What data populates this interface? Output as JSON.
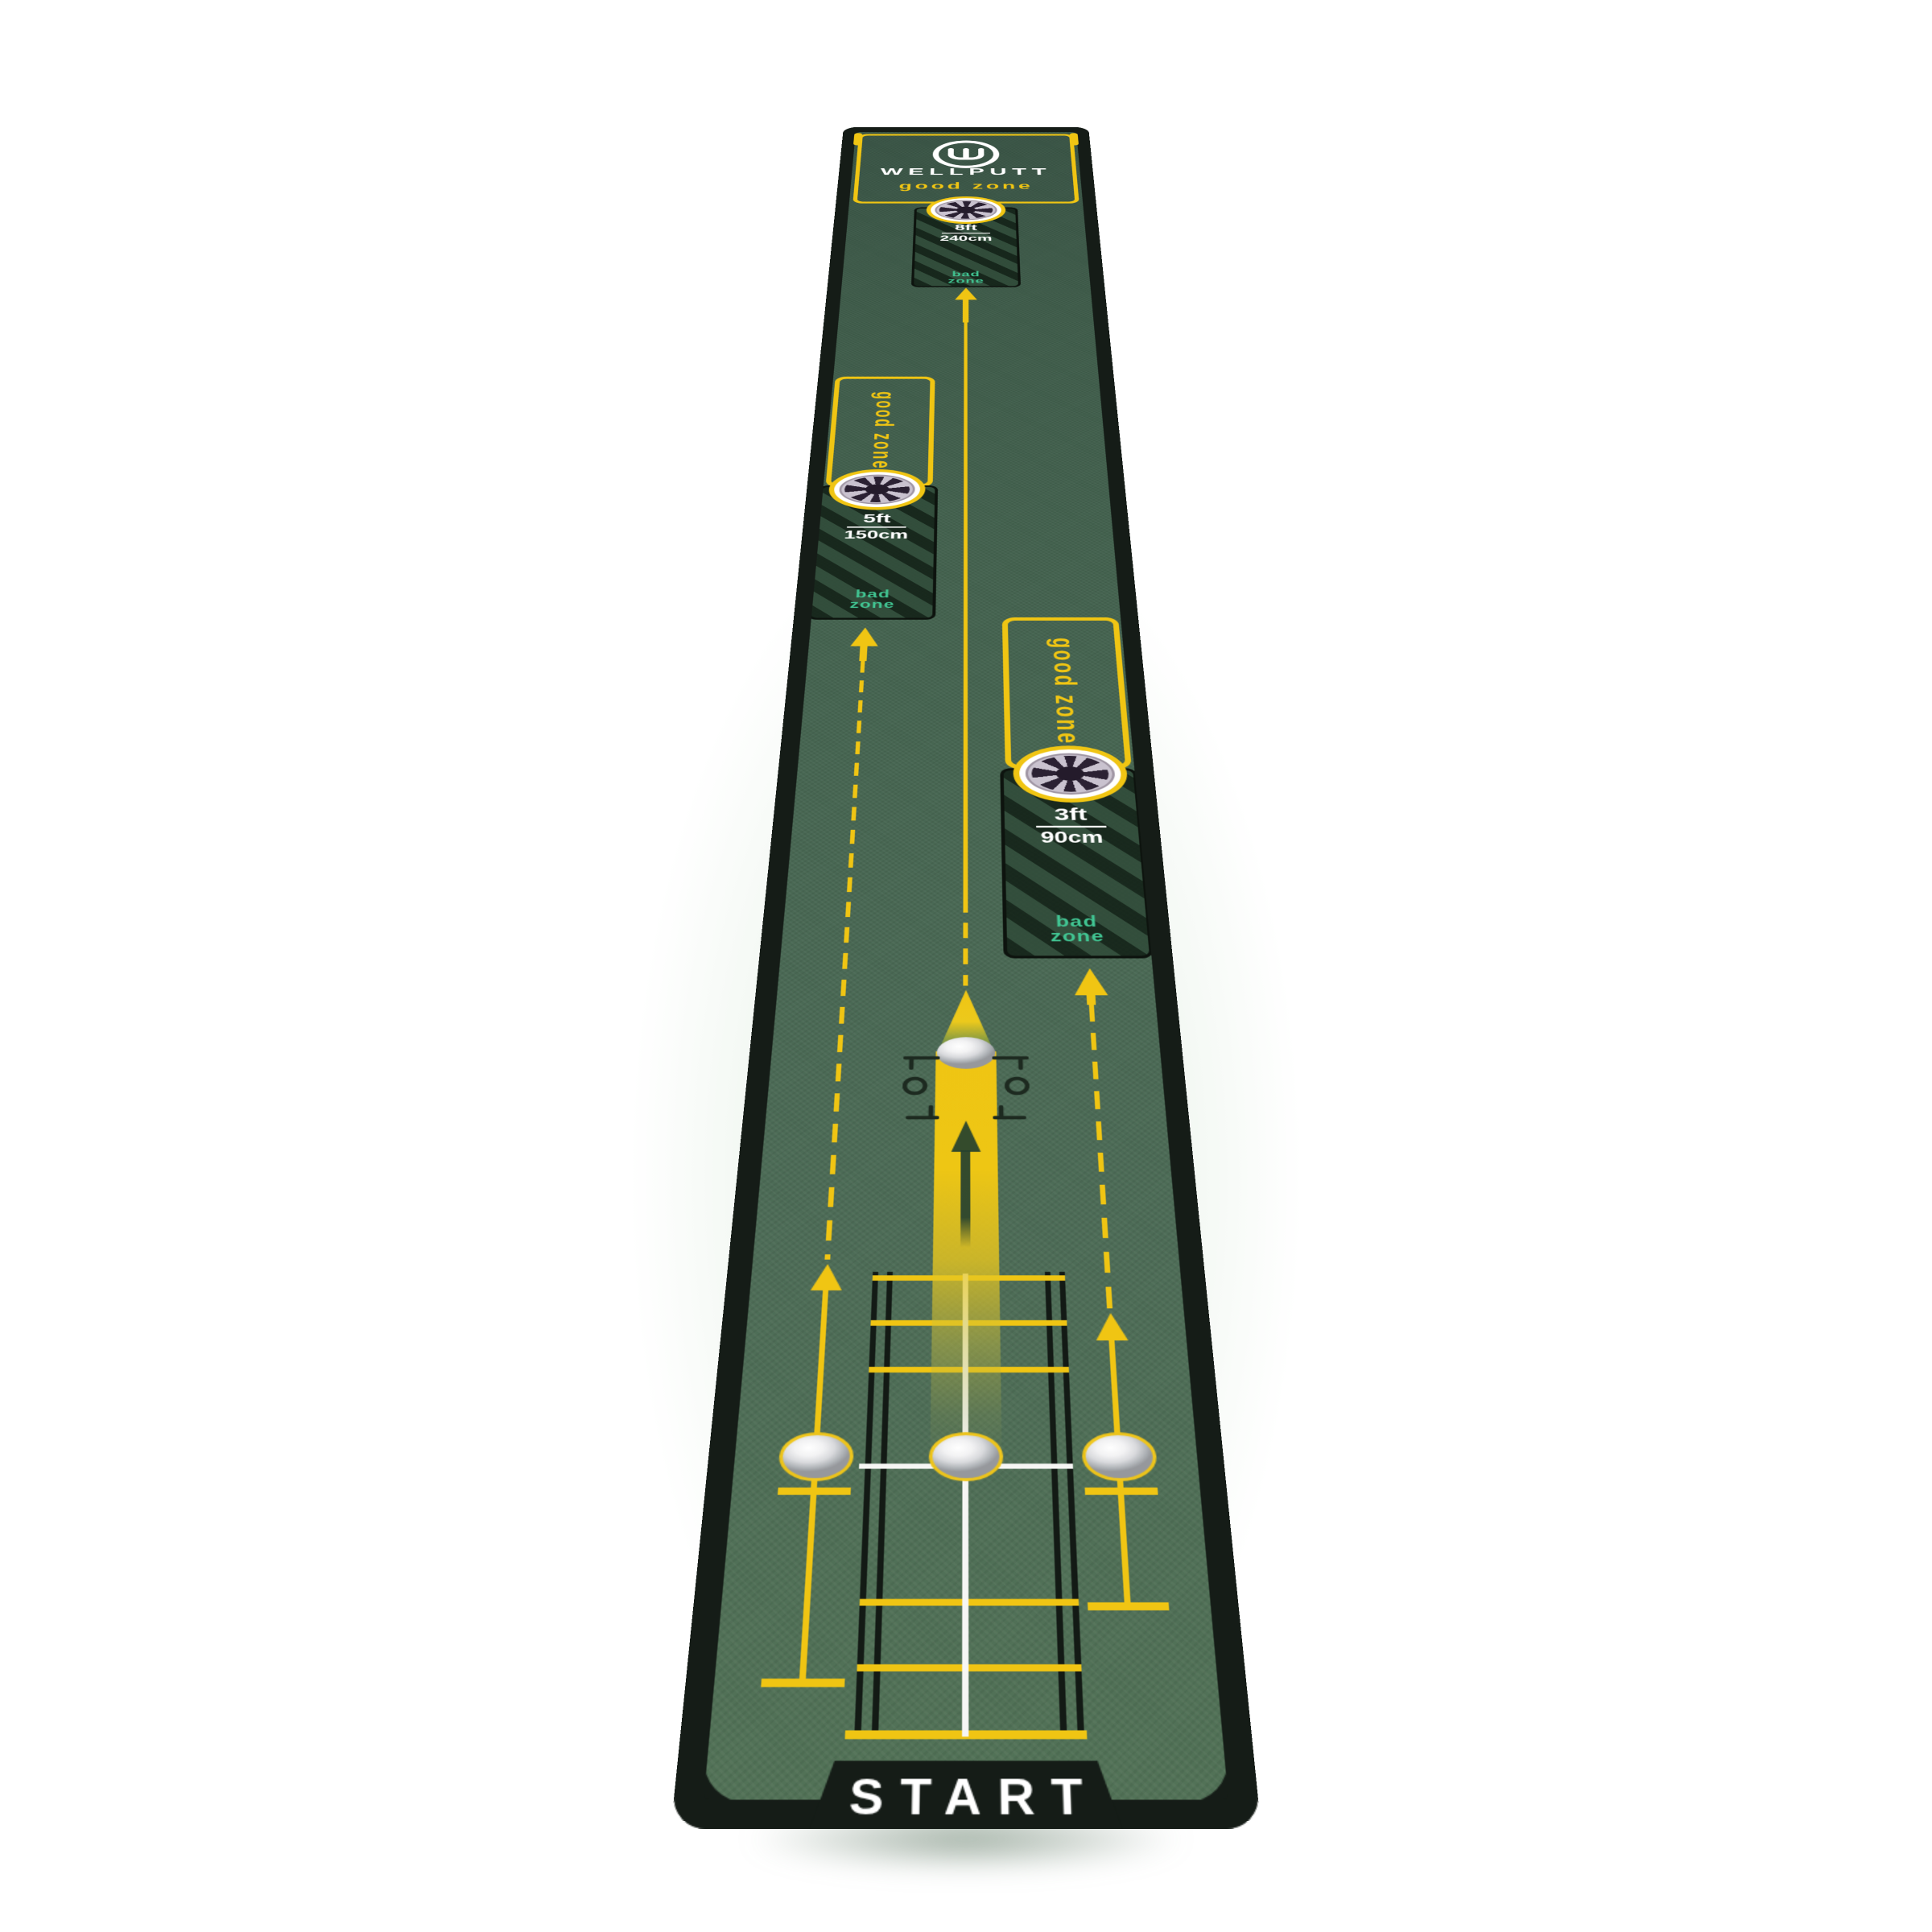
{
  "page": {
    "background_glow_color": "#cde0c9"
  },
  "mat": {
    "brand": "WELLPUTT",
    "start_label": "START",
    "colors": {
      "turf_green": "#466551",
      "edge_black": "#151c17",
      "line_yellow": "#f0c513",
      "bad_zone_teal": "#41c492",
      "text_white": "#ffffff",
      "cup_gray": "#c9c2cf",
      "cup_dark": "#2b2133"
    },
    "icons": {
      "logo": "wellputt-w-logo",
      "hole": "hole-cup",
      "arrow": "up-arrow",
      "ball": "golf-ball",
      "gate": "putter-gate"
    },
    "zones": [
      {
        "name": "8ft-zone",
        "good_zone_label": "good zone",
        "distance_ft": "8ft",
        "distance_cm": "240cm",
        "bad_zone_label": "bad zone"
      },
      {
        "name": "5ft-zone",
        "good_zone_label": "good zone",
        "distance_ft": "5ft",
        "distance_cm": "150cm",
        "bad_zone_label": "bad zone"
      },
      {
        "name": "3ft-zone",
        "good_zone_label": "good zone",
        "distance_ft": "3ft",
        "distance_cm": "90cm",
        "bad_zone_label": "bad zone"
      }
    ]
  }
}
